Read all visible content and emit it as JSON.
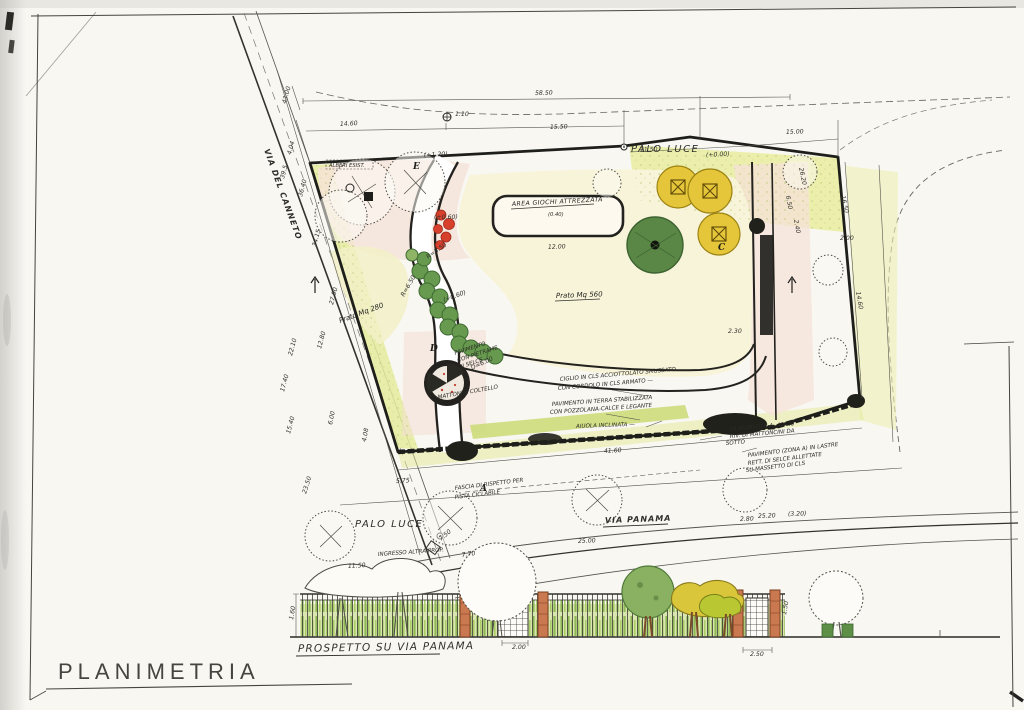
{
  "document": {
    "title": "PLANIMETRIA",
    "elevation_title": "PROSPETTO SU VIA PANAMA"
  },
  "palette": {
    "paper": "#f8f7f2",
    "ink": "#23221e",
    "wash_green": "#e6eb9e",
    "wash_cream": "#f8f4da",
    "wash_pink": "#f5e2d8",
    "tree_green": "#5b8746",
    "shrub_green": "#679a4e",
    "play_yellow": "#e5c53a",
    "flower_red": "#d7402c",
    "brick": "#c9784f"
  },
  "plan": {
    "roads": {
      "left_road": "VIA DEL CANNETO",
      "bottom_road": "VIA PANAMA"
    },
    "labels": {
      "palo_luce_top": "PALO LUCE",
      "palo_luce_bottom": "PALO LUCE",
      "alberi_esistenti": "ALBERI ESIST.",
      "area_giochi": "AREA GIOCHI ATTREZZATA",
      "area_giochi_quota": "(0.40)",
      "prato_main": "Prato Mq 560",
      "prato_left": "Prato Mq 280"
    },
    "markers": [
      {
        "t": "A",
        "x": 480,
        "y": 491
      },
      {
        "t": "D",
        "x": 430,
        "y": 351
      },
      {
        "t": "C",
        "x": 718,
        "y": 250
      },
      {
        "t": "E",
        "x": 413,
        "y": 169
      }
    ],
    "notes": [
      {
        "t": "CIGLIO IN CLS ACCIOTTOLATO SMUSSATO",
        "x": 560,
        "y": 381,
        "r": -5
      },
      {
        "t": "CON CORDOLO IN CLS ARMATO —",
        "x": 558,
        "y": 390,
        "r": -5
      },
      {
        "t": "PAVIMENTO IN TERRA STABILIZZATA",
        "x": 552,
        "y": 406,
        "r": -4
      },
      {
        "t": "CON POZZOLANA-CALCE E LEGANTE",
        "x": 550,
        "y": 414,
        "r": -4
      },
      {
        "t": "AIUOLA INCLINATA —",
        "x": 576,
        "y": 428,
        "r": -2
      },
      {
        "t": "PILASTRI DI C.A. 40x40",
        "x": 730,
        "y": 431,
        "r": -5,
        "s": 5
      },
      {
        "t": "RIV. DI MATTONCINI DA",
        "x": 730,
        "y": 438,
        "r": -5,
        "s": 5
      },
      {
        "t": "SOTTO",
        "x": 726,
        "y": 445,
        "r": -5,
        "s": 5
      },
      {
        "t": "PAVIMENTO (ZONA A) IN LASTRE",
        "x": 748,
        "y": 457,
        "r": -7,
        "s": 5
      },
      {
        "t": "RETT. DI SELCE ALLETTATE",
        "x": 748,
        "y": 465,
        "r": -7,
        "s": 5
      },
      {
        "t": "SU MASSETTO DI CLS",
        "x": 746,
        "y": 472,
        "r": -7,
        "s": 5
      },
      {
        "t": "FASCIA DI RISPETTO PER",
        "x": 455,
        "y": 490,
        "r": -7
      },
      {
        "t": "PISTA CICLABILE",
        "x": 455,
        "y": 499,
        "r": -7
      },
      {
        "t": "PAVIMENTO",
        "x": 455,
        "y": 355,
        "r": -18,
        "s": 4.8
      },
      {
        "t": "CON PIETRAME",
        "x": 458,
        "y": 362,
        "r": -18,
        "s": 4.8
      },
      {
        "t": "DI SELCE",
        "x": 459,
        "y": 369,
        "r": -18,
        "s": 4.8
      },
      {
        "t": "MATTONI A COLTELLO",
        "x": 438,
        "y": 399,
        "r": -10,
        "s": 5
      },
      {
        "t": "INGRESSO ALTRA PROP.",
        "x": 378,
        "y": 556,
        "r": -4,
        "s": 4.6
      }
    ],
    "dimensions": [
      {
        "t": "58.50",
        "x": 535,
        "y": 95,
        "r": -1
      },
      {
        "t": "14.60",
        "x": 340,
        "y": 126,
        "r": -3
      },
      {
        "t": "1.10",
        "x": 455,
        "y": 116,
        "s": 5.5
      },
      {
        "t": "15.50",
        "x": 550,
        "y": 129,
        "r": -2
      },
      {
        "t": "11.50",
        "x": 640,
        "y": 152,
        "r": -3
      },
      {
        "t": "15.00",
        "x": 786,
        "y": 134,
        "r": -2
      },
      {
        "t": "(+0.00)",
        "x": 706,
        "y": 157,
        "r": -3,
        "s": 5.2
      },
      {
        "t": "(+1.20)",
        "x": 424,
        "y": 157,
        "r": -3,
        "s": 5.2
      },
      {
        "t": "(+0.60)",
        "x": 434,
        "y": 219,
        "s": 5
      },
      {
        "t": "26.20",
        "x": 799,
        "y": 168,
        "r": 78,
        "s": 5.4
      },
      {
        "t": "6.50",
        "x": 786,
        "y": 196,
        "r": 80,
        "s": 5.4
      },
      {
        "t": "2.40",
        "x": 794,
        "y": 220,
        "r": 80,
        "s": 5.4
      },
      {
        "t": "16.50",
        "x": 841,
        "y": 196,
        "r": 78,
        "s": 5.4
      },
      {
        "t": "2.00",
        "x": 840,
        "y": 240,
        "s": 5.4
      },
      {
        "t": "14.60",
        "x": 856,
        "y": 292,
        "r": 80,
        "s": 5.4
      },
      {
        "t": "2.30",
        "x": 728,
        "y": 333,
        "s": 5.4
      },
      {
        "t": "43.00",
        "x": 286,
        "y": 104,
        "r": -75
      },
      {
        "t": "4.04",
        "x": 291,
        "y": 155,
        "r": -75,
        "s": 5.2
      },
      {
        "t": "39.5",
        "x": 284,
        "y": 179,
        "r": -75,
        "s": 5.2
      },
      {
        "t": "36.40",
        "x": 302,
        "y": 197,
        "r": -75
      },
      {
        "t": "34.15",
        "x": 316,
        "y": 247,
        "r": -75
      },
      {
        "t": "27.90",
        "x": 333,
        "y": 305,
        "r": -75,
        "s": 5.4
      },
      {
        "t": "23.50",
        "x": 306,
        "y": 494,
        "r": -72
      },
      {
        "t": "22.10",
        "x": 292,
        "y": 356,
        "r": -75
      },
      {
        "t": "17.40",
        "x": 284,
        "y": 392,
        "r": -75
      },
      {
        "t": "15.40",
        "x": 290,
        "y": 434,
        "r": -75
      },
      {
        "t": "12.80",
        "x": 321,
        "y": 349,
        "r": -75
      },
      {
        "t": "6.00",
        "x": 332,
        "y": 425,
        "r": -78,
        "s": 5.4
      },
      {
        "t": "4.08",
        "x": 366,
        "y": 442,
        "r": -80,
        "s": 5.2
      },
      {
        "t": "12.00",
        "x": 548,
        "y": 249,
        "r": -2
      },
      {
        "t": "R=8.50",
        "x": 428,
        "y": 259,
        "r": -35,
        "s": 5.2
      },
      {
        "t": "R=6.50",
        "x": 404,
        "y": 297,
        "r": -60,
        "s": 5.2
      },
      {
        "t": "(+0.60)",
        "x": 444,
        "y": 302,
        "r": -20,
        "s": 5
      },
      {
        "t": "D=6.00",
        "x": 472,
        "y": 370,
        "r": -25,
        "s": 5.2
      },
      {
        "t": "5.75",
        "x": 396,
        "y": 483,
        "r": -3
      },
      {
        "t": "7.50",
        "x": 441,
        "y": 541,
        "r": -40,
        "s": 5.2
      },
      {
        "t": "7.70",
        "x": 462,
        "y": 557,
        "r": -8,
        "s": 5.2
      },
      {
        "t": "11.50",
        "x": 348,
        "y": 568,
        "r": -3,
        "s": 5.2
      },
      {
        "t": "25.00",
        "x": 578,
        "y": 543,
        "r": -2
      },
      {
        "t": "2.80",
        "x": 740,
        "y": 521,
        "r": -2,
        "s": 5.2
      },
      {
        "t": "25.20",
        "x": 758,
        "y": 518,
        "r": -2,
        "s": 5.2
      },
      {
        "t": "(3.20)",
        "x": 788,
        "y": 516,
        "r": -2,
        "s": 5.2
      },
      {
        "t": "41.60",
        "x": 604,
        "y": 453,
        "r": -3,
        "s": 5.4
      },
      {
        "t": "2.00",
        "x": 512,
        "y": 649
      },
      {
        "t": "2.50",
        "x": 750,
        "y": 656
      },
      {
        "t": "1.60",
        "x": 293,
        "y": 620,
        "r": -80,
        "s": 5.2
      },
      {
        "t": "1.50",
        "x": 786,
        "y": 615,
        "r": -80,
        "s": 5
      }
    ]
  }
}
